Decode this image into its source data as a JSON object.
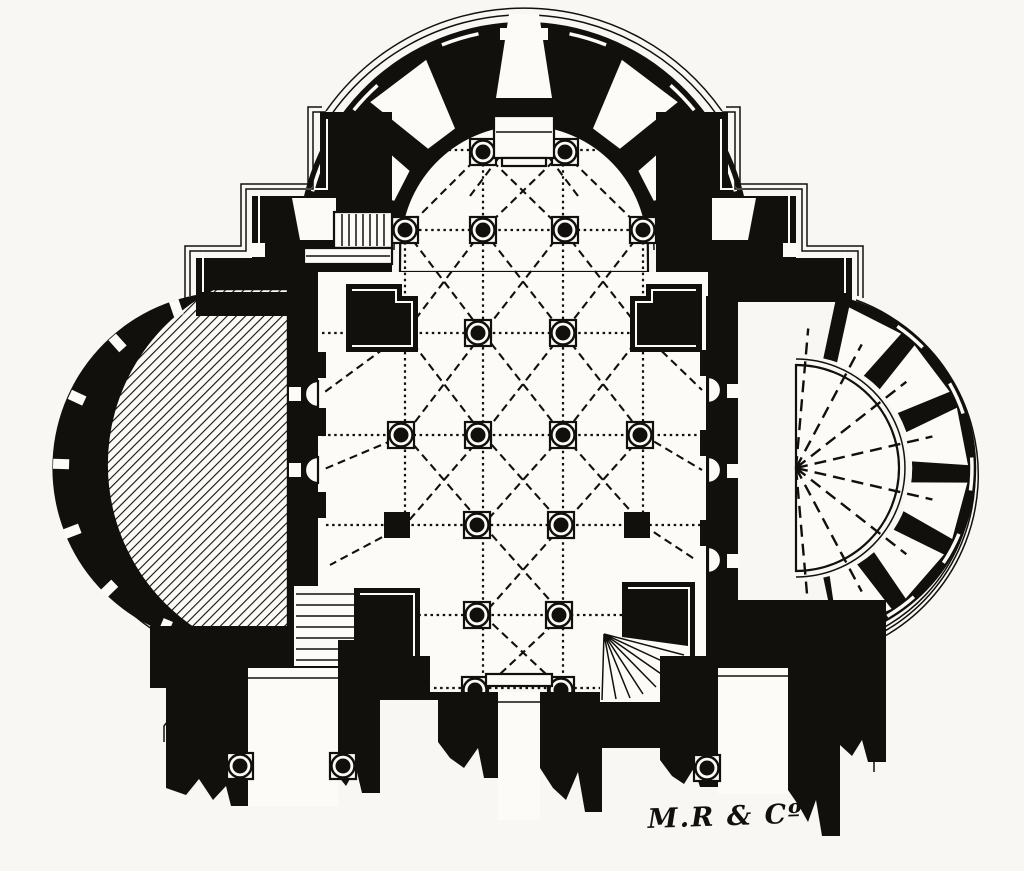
{
  "figure": {
    "kind": "architectural floor plan engraving",
    "signature": {
      "text": "M.R & Cº"
    }
  },
  "colors": {
    "paper": "#f8f7f3",
    "ink": "#12100d"
  }
}
